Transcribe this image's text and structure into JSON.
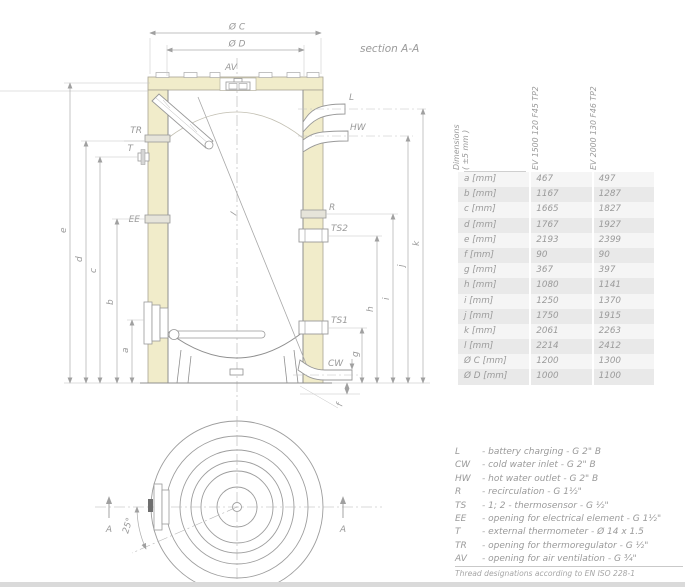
{
  "section_view": {
    "title": "section A-A",
    "dims": {
      "oc": "Ø C",
      "od": "Ø D",
      "a": "a",
      "b": "b",
      "c": "c",
      "d": "d",
      "e": "e",
      "f": "f",
      "g": "g",
      "h": "h",
      "i": "i",
      "j": "j",
      "k": "k",
      "l": "l"
    },
    "connections": {
      "av": "AV",
      "l": "L",
      "hw": "HW",
      "tr": "TR",
      "t": "T",
      "ee": "EE",
      "r": "R",
      "ts2": "TS2",
      "ts1": "TS1",
      "cw": "CW"
    }
  },
  "top_view": {
    "marker_left": "A",
    "marker_right": "A",
    "angle": "25°"
  },
  "table": {
    "header_dim": "Dimensions",
    "header_tol": "( ±5 mm )",
    "columns": [
      "EV 1500 120 F45 TP2",
      "EV 2000 130 F46 TP2"
    ],
    "rows": [
      {
        "label": "a [mm]",
        "v1": "467",
        "v2": "497"
      },
      {
        "label": "b [mm]",
        "v1": "1167",
        "v2": "1287"
      },
      {
        "label": "c [mm]",
        "v1": "1665",
        "v2": "1827"
      },
      {
        "label": "d [mm]",
        "v1": "1767",
        "v2": "1927"
      },
      {
        "label": "e [mm]",
        "v1": "2193",
        "v2": "2399"
      },
      {
        "label": "f [mm]",
        "v1": "90",
        "v2": "90"
      },
      {
        "label": "g [mm]",
        "v1": "367",
        "v2": "397"
      },
      {
        "label": "h [mm]",
        "v1": "1080",
        "v2": "1141"
      },
      {
        "label": "i [mm]",
        "v1": "1250",
        "v2": "1370"
      },
      {
        "label": "j [mm]",
        "v1": "1750",
        "v2": "1915"
      },
      {
        "label": "k [mm]",
        "v1": "2061",
        "v2": "2263"
      },
      {
        "label": "l [mm]",
        "v1": "2214",
        "v2": "2412"
      },
      {
        "label": "Ø C [mm]",
        "v1": "1200",
        "v2": "1300"
      },
      {
        "label": "Ø D [mm]",
        "v1": "1000",
        "v2": "1100"
      }
    ]
  },
  "legend": {
    "items": [
      {
        "code": "L",
        "desc": "- battery charging - G 2\" B"
      },
      {
        "code": "CW",
        "desc": "- cold water inlet - G 2\" B"
      },
      {
        "code": "HW",
        "desc": "- hot water outlet - G 2\" B"
      },
      {
        "code": "R",
        "desc": "- recirculation - G 1½\""
      },
      {
        "code": "TS",
        "desc": "- 1; 2 - thermosensor - G ½\""
      },
      {
        "code": "EE",
        "desc": "- opening for electrical element - G 1½\""
      },
      {
        "code": "T",
        "desc": "- external thermometer - Ø 14 x 1.5"
      },
      {
        "code": "TR",
        "desc": "- opening for thermoregulator - G ½\""
      },
      {
        "code": "AV",
        "desc": "- opening for air ventilation - G ¾\""
      }
    ]
  },
  "footnote": "Thread designations according to EN ISO 228-1",
  "colors": {
    "insulation": "#f1ecca",
    "line": "#999999",
    "dim": "#ababab",
    "text": "#9a9a9a"
  }
}
